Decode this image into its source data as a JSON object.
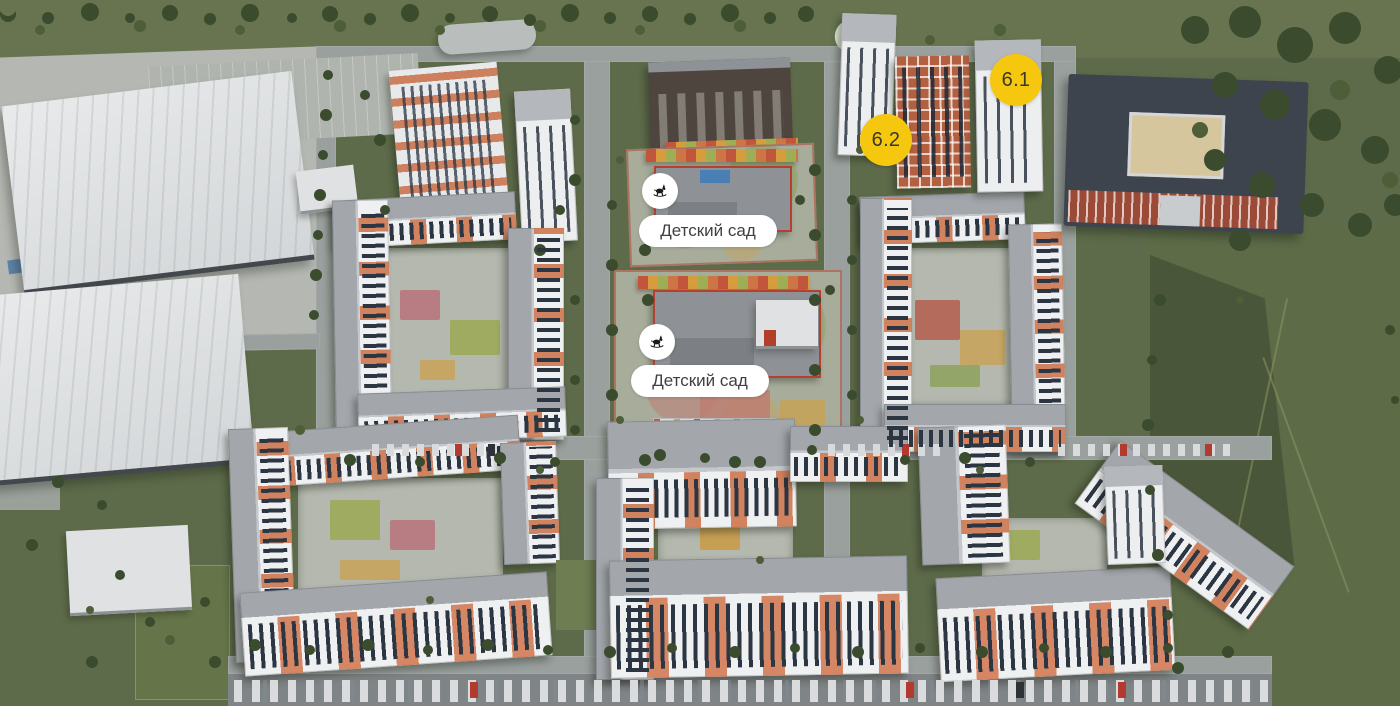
{
  "markers": {
    "badge_color": "#F6C70F",
    "badge_text_color": "#3A372C",
    "building_badges": [
      {
        "label": "6.1"
      },
      {
        "label": "6.2"
      }
    ],
    "poi_markers": [
      {
        "label": "Детский сад",
        "icon": "rocking-horse-icon"
      },
      {
        "label": "Детский сад",
        "icon": "rocking-horse-icon"
      }
    ],
    "partial_marker": {
      "icon": "map-balloon-partial",
      "color": "#F2F7EC"
    }
  }
}
